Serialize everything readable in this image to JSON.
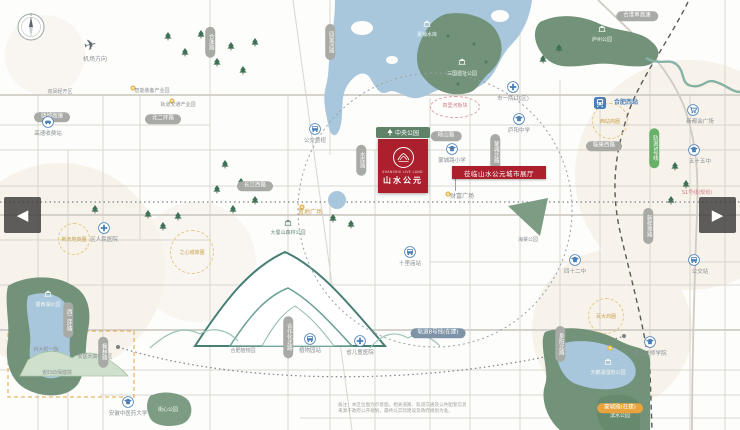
{
  "palette": {
    "background": "#fdfdfb",
    "road": "#d9d6cf",
    "park_green": "#72937a",
    "park_dark": "#5f8268",
    "water_blue": "#a9c7dc",
    "project_red": "#ac1f2d",
    "pill_gray": "#a8aaa5",
    "beige_wash": "#f0e7d8",
    "metro_green": "#69b06b",
    "orange": "#e8a33d",
    "label_gray": "#8a8f94",
    "poi_blue": "#4a7fb5"
  },
  "nav": {
    "left": "◀",
    "right": "▶"
  },
  "airport": {
    "label": "机场方向"
  },
  "project": {
    "park_pill": "中央公园",
    "logo_en": "SHANSHUI LIVE LAND",
    "name_cn": "山水公元",
    "banner": "莅临山水公元城市展厅"
  },
  "zone_ellipse": {
    "x": 455,
    "y": 107,
    "rx": 24,
    "ry": 10,
    "text": "四里河板块"
  },
  "water_parks": [
    {
      "x": 427,
      "y": 33,
      "text": "董铺水库",
      "style": "water",
      "pav": true,
      "pavy": 20
    },
    {
      "x": 462,
      "y": 72,
      "text": "三国遗址公园",
      "style": "white",
      "pav": true,
      "pavy": 58
    },
    {
      "x": 602,
      "y": 38,
      "text": "庐州公园",
      "style": "white",
      "pav": true,
      "pavy": 25
    },
    {
      "x": 48,
      "y": 303,
      "text": "蜀西湖公园",
      "style": "white",
      "pav": true,
      "pavy": 290
    },
    {
      "x": 608,
      "y": 371,
      "text": "天鹅湖湿地公园",
      "style": "white",
      "pav": true,
      "pavy": 358
    },
    {
      "x": 620,
      "y": 414,
      "text": "滨水公园",
      "style": "white",
      "pav": false,
      "pavy": 0
    },
    {
      "x": 168,
      "y": 408,
      "text": "街心公园",
      "style": "white",
      "pav": false,
      "pavy": 0
    },
    {
      "x": 288,
      "y": 231,
      "text": "大蜀山森林公园",
      "style": "green",
      "pav": true,
      "pavy": 219
    }
  ],
  "labels": [
    {
      "x": 60,
      "y": 90,
      "text": "双凤经开区",
      "style": "tiny"
    },
    {
      "x": 152,
      "y": 89,
      "text": "智能装备产业园",
      "style": "tiny"
    },
    {
      "x": 178,
      "y": 103,
      "text": "轨道交通产业园",
      "style": "tiny"
    },
    {
      "x": 462,
      "y": 194,
      "text": "财富广场",
      "style": ""
    },
    {
      "x": 310,
      "y": 210,
      "text": "置地广场",
      "style": "orange"
    },
    {
      "x": 528,
      "y": 238,
      "text": "海棠公园",
      "style": "tiny"
    },
    {
      "x": 46,
      "y": 348,
      "text": "科大附一院",
      "style": "tiny"
    },
    {
      "x": 95,
      "y": 355,
      "text": "安医大高新院区",
      "style": "tiny"
    },
    {
      "x": 57,
      "y": 371,
      "text": "省妇幼保健院",
      "style": "tiny"
    },
    {
      "x": 243,
      "y": 349,
      "text": "合肥植物园",
      "style": "tiny"
    },
    {
      "x": 697,
      "y": 191,
      "text": "S1号线(规划)",
      "style": "pink tiny"
    }
  ],
  "pills_h": [
    {
      "x": 52,
      "y": 117,
      "text": "绕城高速",
      "color": ""
    },
    {
      "x": 163,
      "y": 119,
      "text": "北二环路",
      "color": ""
    },
    {
      "x": 255,
      "y": 186,
      "text": "长江西路",
      "color": ""
    },
    {
      "x": 446,
      "y": 136,
      "text": "砀山路",
      "color": ""
    },
    {
      "x": 604,
      "y": 146,
      "text": "临泉西路",
      "color": ""
    },
    {
      "x": 637,
      "y": 16,
      "text": "合淮阜高速",
      "color": ""
    },
    {
      "x": 438,
      "y": 333,
      "text": "轨道8号线(在建)",
      "color": "blue"
    },
    {
      "x": 620,
      "y": 408,
      "text": "蒙城路(在建)",
      "color": "orange"
    }
  ],
  "pills_v": [
    {
      "x": 210,
      "y": 42,
      "text": "合淮路",
      "color": ""
    },
    {
      "x": 330,
      "y": 42,
      "text": "四里河路",
      "color": ""
    },
    {
      "x": 68,
      "y": 320,
      "text": "西二环路",
      "color": ""
    },
    {
      "x": 103,
      "y": 352,
      "text": "枫林路",
      "color": ""
    },
    {
      "x": 288,
      "y": 337,
      "text": "合作化北路",
      "color": ""
    },
    {
      "x": 495,
      "y": 152,
      "text": "蒙城北路",
      "color": ""
    },
    {
      "x": 361,
      "y": 160,
      "text": "水库路",
      "color": ""
    },
    {
      "x": 560,
      "y": 344,
      "text": "阜阳北路",
      "color": ""
    },
    {
      "x": 648,
      "y": 226,
      "text": "新蚌埠路",
      "color": ""
    },
    {
      "x": 654,
      "y": 148,
      "text": "轨道5号线",
      "color": "green"
    }
  ],
  "zones": [
    {
      "x": 192,
      "y": 252,
      "r": 21,
      "text": "之心城商圈"
    },
    {
      "x": 610,
      "y": 121,
      "r": 17,
      "text": "西站商圈"
    },
    {
      "x": 606,
      "y": 316,
      "r": 17,
      "text": "百大商圈"
    },
    {
      "x": 74,
      "y": 239,
      "r": 15,
      "text": "新天地商圈"
    }
  ],
  "pois": [
    {
      "x": 48,
      "y": 122,
      "icon": "car",
      "label": "高速收费站",
      "lx": 48,
      "ly": 129
    },
    {
      "x": 513,
      "y": 87,
      "icon": "hospital",
      "label": "市一院(北区)",
      "lx": 513,
      "ly": 94
    },
    {
      "x": 519,
      "y": 119,
      "icon": "school",
      "label": "庐阳中学",
      "lx": 519,
      "ly": 126
    },
    {
      "x": 452,
      "y": 149,
      "icon": "school",
      "label": "蒙城路小学",
      "lx": 452,
      "ly": 156
    },
    {
      "x": 315,
      "y": 129,
      "icon": "bus",
      "label": "公交枢纽",
      "lx": 315,
      "ly": 136
    },
    {
      "x": 104,
      "y": 228,
      "icon": "hospital",
      "label": "区人民医院",
      "lx": 104,
      "ly": 235
    },
    {
      "x": 410,
      "y": 252,
      "icon": "bus",
      "label": "十里庙站",
      "lx": 410,
      "ly": 259
    },
    {
      "x": 310,
      "y": 339,
      "icon": "bus",
      "label": "植物园站",
      "lx": 310,
      "ly": 346
    },
    {
      "x": 360,
      "y": 341,
      "icon": "hospital",
      "label": "省儿童医院",
      "lx": 360,
      "ly": 348
    },
    {
      "x": 128,
      "y": 402,
      "icon": "school",
      "label": "安徽中医药大学",
      "lx": 128,
      "ly": 409
    },
    {
      "x": 575,
      "y": 260,
      "icon": "school",
      "label": "四十二中",
      "lx": 575,
      "ly": 267
    },
    {
      "x": 650,
      "y": 342,
      "icon": "school",
      "label": "建工技师学院",
      "lx": 650,
      "ly": 349
    },
    {
      "x": 693,
      "y": 110,
      "icon": "cart",
      "label": "新都会广场",
      "lx": 700,
      "ly": 117
    },
    {
      "x": 694,
      "y": 150,
      "icon": "school",
      "label": "五十五中",
      "lx": 700,
      "ly": 157
    },
    {
      "x": 694,
      "y": 260,
      "icon": "bus",
      "label": "公交站",
      "lx": 700,
      "ly": 267
    }
  ],
  "station": {
    "x": 600,
    "y": 103,
    "label": "合肥西站",
    "lx": 626,
    "ly": 100
  },
  "disclaimer": {
    "line1": "备注：本区位图为示意图，相关道路、轨道交通及公共配套信息",
    "line2": "来源于政府公开规划，最终以实际建设及政府规划为准。"
  }
}
